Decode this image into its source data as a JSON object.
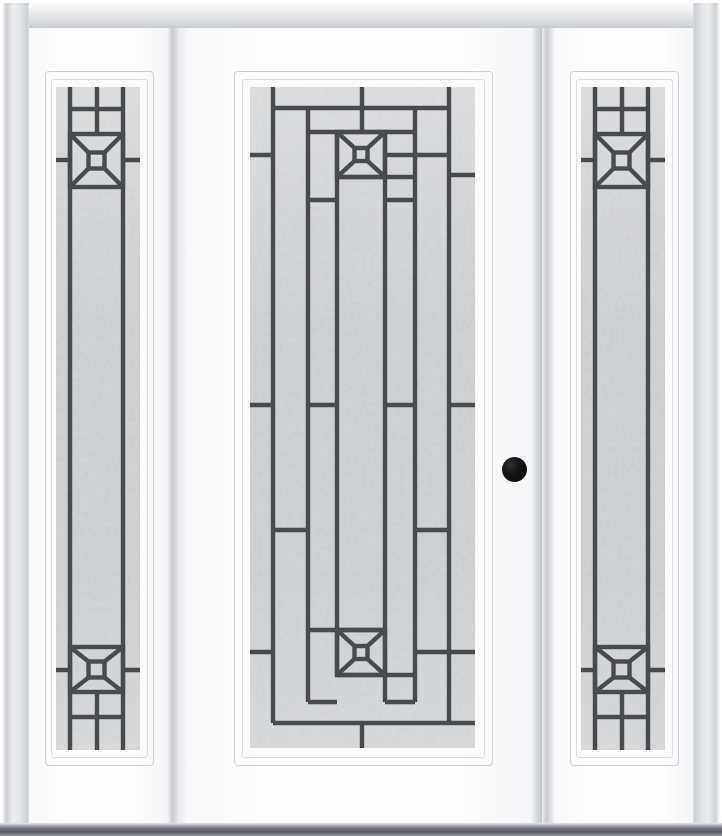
{
  "scene": {
    "description": "Product photo of a white prehung entry door with a full-length decorative leaded-glass lite, flanked by two matching full-lite sidelites, black round bore knob, light gray brickmould frame and dark gray sill on a white background",
    "glass_style": "courtyard caming pattern with pyramid-square medallions at top and bottom"
  },
  "colors": {
    "background": "#ffffff",
    "panel_white": "#fcfdfd",
    "caming": "#474b4f",
    "glass_base": "#d2d4d6",
    "moulding_line": "#cdd1d5",
    "brickmould": "#e0e3e6",
    "mullion_shadow": "#c9ccd0",
    "sill_dark": "#575b60",
    "sill_light": "#b3b7bb",
    "knob_black": "#0a0a0a"
  },
  "door": {
    "knob": {
      "cx": 515,
      "cy": 470,
      "r": 12.5
    },
    "glass": {
      "x": 250,
      "y": 87,
      "w": 225,
      "h": 661
    },
    "pattern": {
      "stroke_width": 4.4,
      "square": 13,
      "verticals": [
        {
          "x": 23,
          "y1": 0,
          "y2": 636
        },
        {
          "x": 58,
          "y1": 21,
          "y2": 615
        },
        {
          "x": 87,
          "y1": 45,
          "y2": 588
        },
        {
          "x": 112,
          "y1": 0,
          "y2": 45
        },
        {
          "x": 112,
          "y1": 636,
          "y2": 661
        },
        {
          "x": 135,
          "y1": 45,
          "y2": 615
        },
        {
          "x": 165,
          "y1": 21,
          "y2": 615
        },
        {
          "x": 199,
          "y1": 0,
          "y2": 636
        }
      ],
      "horizontals": [
        {
          "y": 21,
          "spans": [
            [
              23,
              199
            ]
          ]
        },
        {
          "y": 45,
          "spans": [
            [
              58,
              165
            ]
          ]
        },
        {
          "y": 68,
          "spans": [
            [
              0,
              23
            ],
            [
              135,
              199
            ]
          ]
        },
        {
          "y": 88,
          "spans": [
            [
              199,
              225
            ]
          ]
        },
        {
          "y": 90,
          "spans": [
            [
              87,
              165
            ]
          ]
        },
        {
          "y": 113,
          "spans": [
            [
              58,
              87
            ],
            [
              135,
              165
            ]
          ]
        },
        {
          "y": 318,
          "spans": [
            [
              0,
              23
            ],
            [
              58,
              87
            ],
            [
              135,
              165
            ],
            [
              199,
              225
            ]
          ]
        },
        {
          "y": 443,
          "spans": [
            [
              23,
              58
            ],
            [
              165,
              199
            ]
          ]
        },
        {
          "y": 543,
          "spans": [
            [
              58,
              135
            ]
          ]
        },
        {
          "y": 565,
          "spans": [
            [
              0,
              23
            ],
            [
              165,
              225
            ]
          ]
        },
        {
          "y": 588,
          "spans": [
            [
              87,
              165
            ]
          ]
        },
        {
          "y": 615,
          "spans": [
            [
              58,
              87
            ],
            [
              135,
              165
            ]
          ]
        },
        {
          "y": 636,
          "spans": [
            [
              23,
              225
            ]
          ]
        }
      ],
      "boxes": [
        {
          "x": 87,
          "y": 45,
          "w": 48,
          "h": 45
        },
        {
          "x": 87,
          "y": 543,
          "w": 48,
          "h": 45
        }
      ]
    }
  },
  "sidelites": {
    "glass_left": {
      "x": 56,
      "y": 87,
      "w": 84,
      "h": 663
    },
    "glass_right": {
      "x": 582,
      "y": 87,
      "w": 84,
      "h": 663
    },
    "pattern": {
      "stroke_width": 4.4,
      "square": 16,
      "verticals": [
        {
          "x": 14,
          "y1": 0,
          "y2": 663
        },
        {
          "x": 67,
          "y1": 0,
          "y2": 663
        },
        {
          "x": 41,
          "y1": 0,
          "y2": 47
        },
        {
          "x": 41,
          "y1": 605,
          "y2": 663
        }
      ],
      "horizontals": [
        {
          "y": 22,
          "spans": [
            [
              14,
              67
            ]
          ]
        },
        {
          "y": 73,
          "spans": [
            [
              0,
              14
            ],
            [
              67,
              84
            ]
          ]
        },
        {
          "y": 583,
          "spans": [
            [
              0,
              14
            ],
            [
              67,
              84
            ]
          ]
        },
        {
          "y": 630,
          "spans": [
            [
              14,
              67
            ]
          ]
        }
      ],
      "boxes": [
        {
          "x": 14,
          "y": 47,
          "w": 53,
          "h": 53
        },
        {
          "x": 14,
          "y": 560,
          "w": 53,
          "h": 45
        }
      ]
    }
  }
}
